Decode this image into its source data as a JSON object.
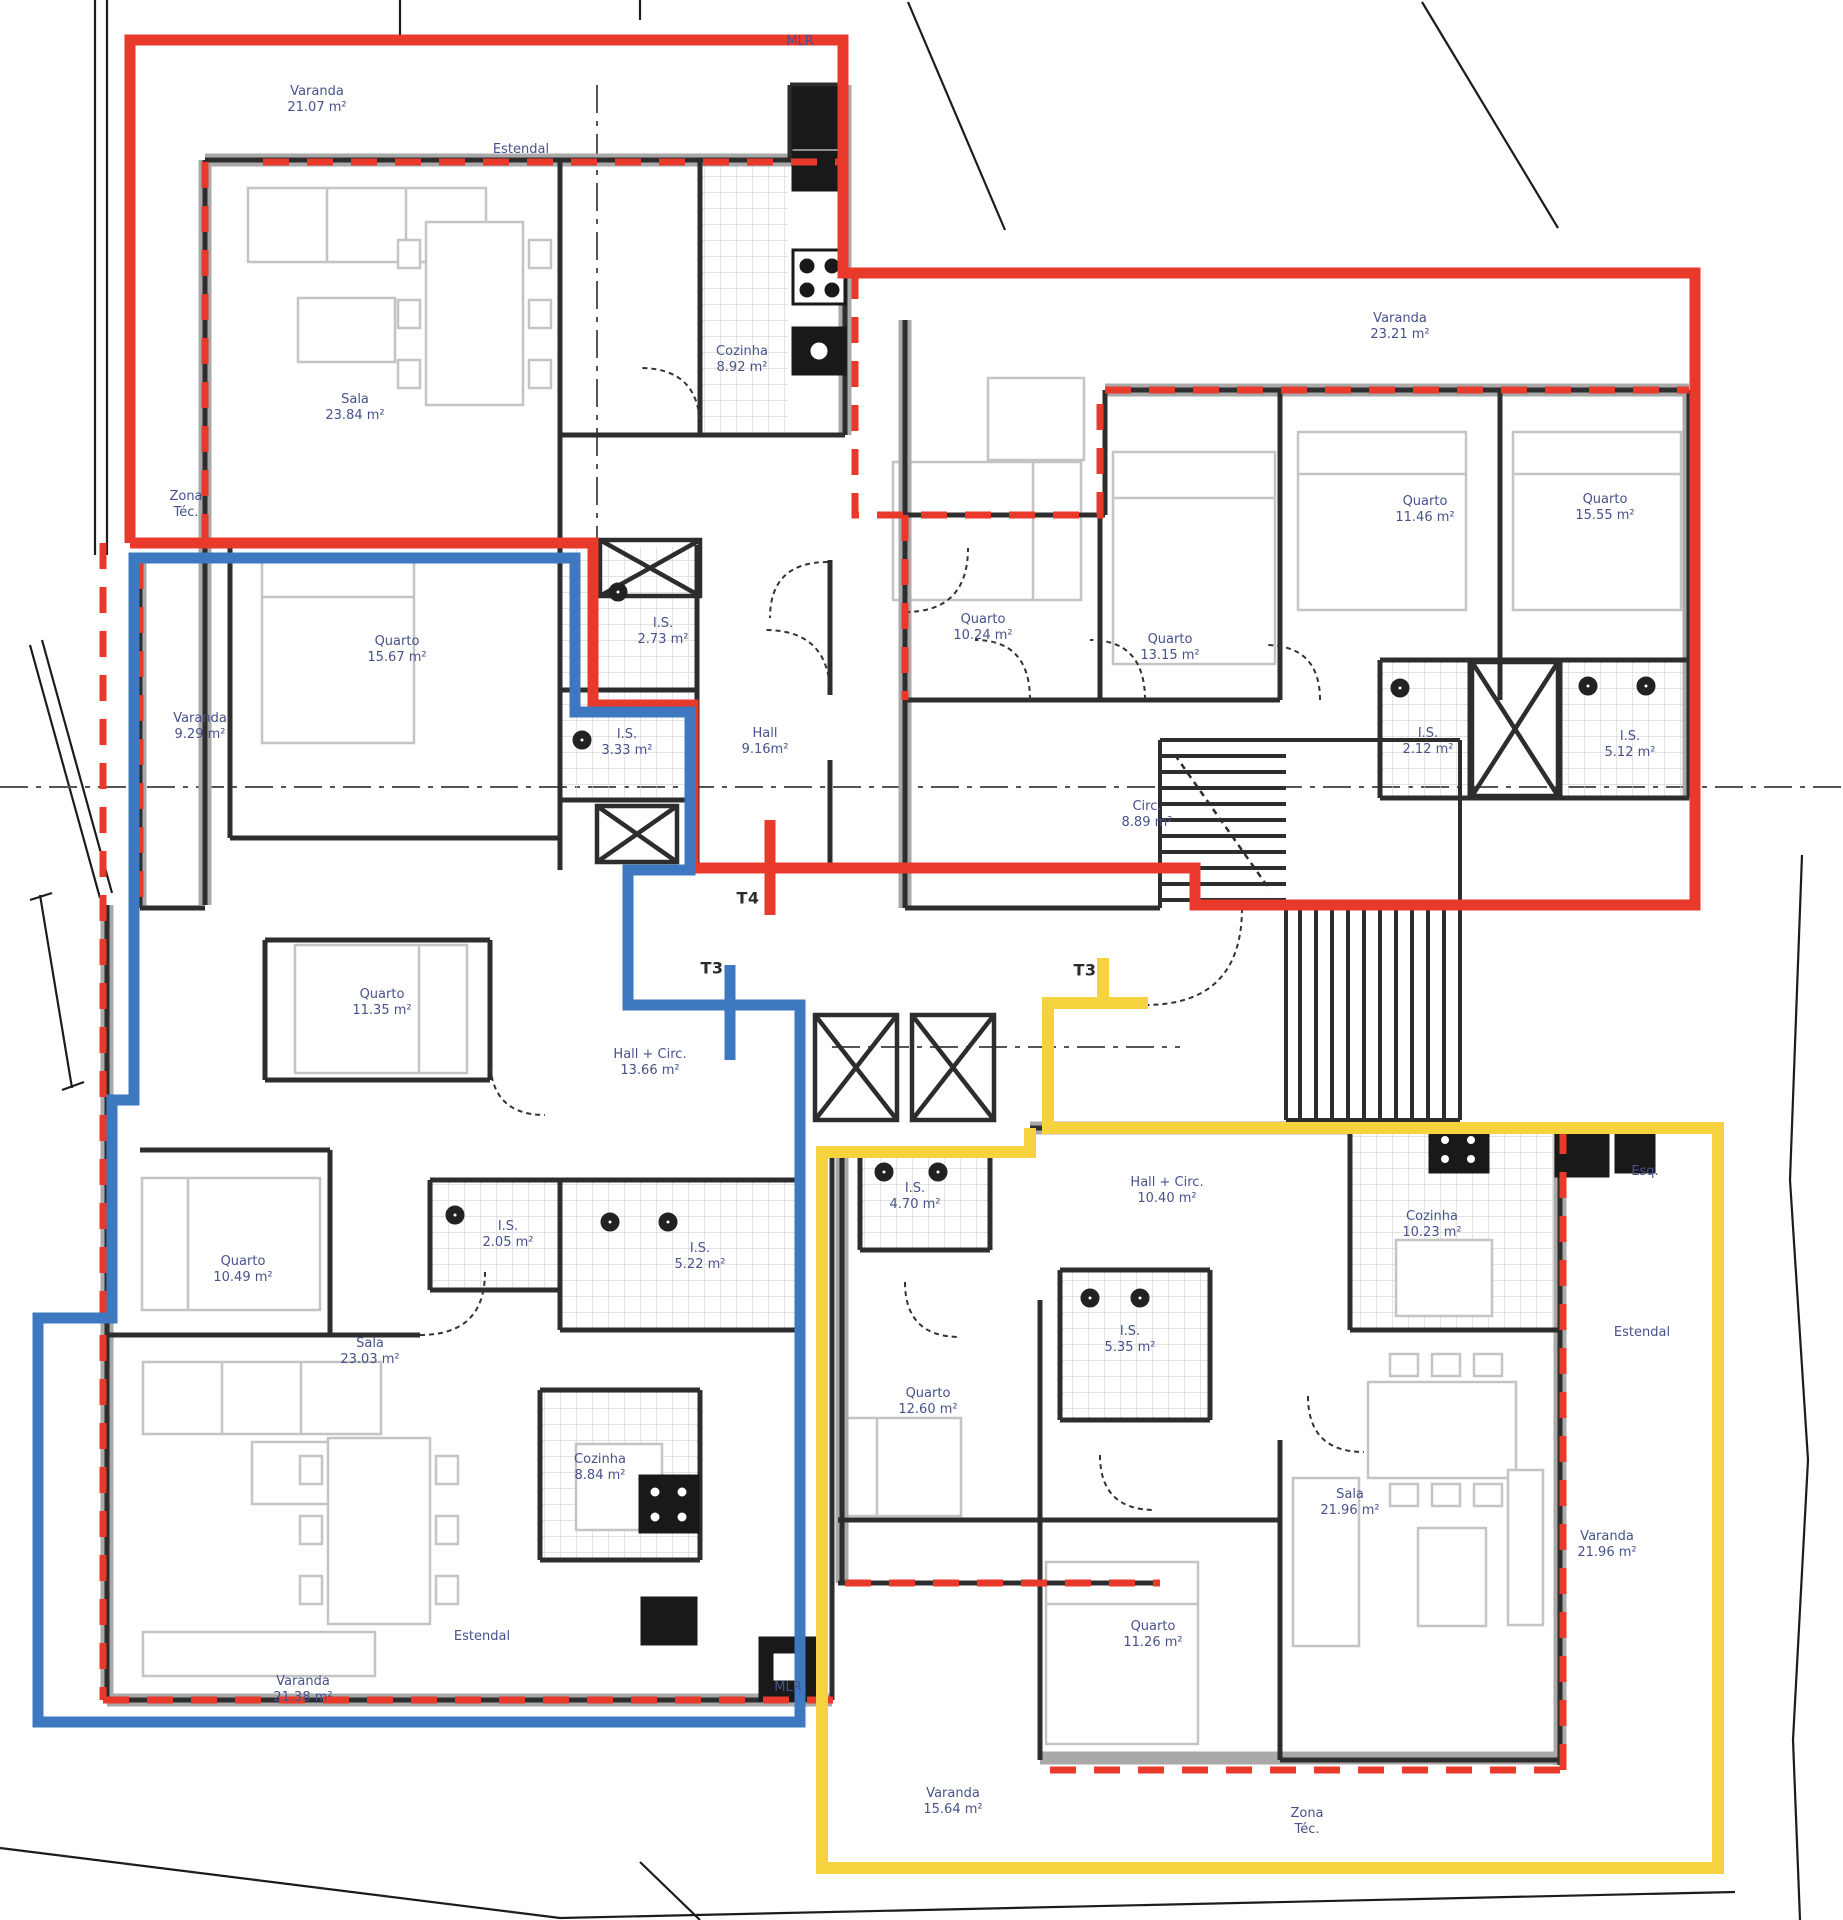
{
  "plan": {
    "kind": "architectural-floor-plan",
    "language": "pt",
    "units_shown": 3
  },
  "colors": {
    "apartment_red": "#e8392b",
    "apartment_blue": "#3d78c0",
    "apartment_yellow": "#f6d23e",
    "wall_dark": "#2d2d2d",
    "wall_gray": "#a9a9a9",
    "furniture": "#c4c4c4",
    "label_blue": "#47528a"
  },
  "apartments": [
    {
      "id": "apartment-red",
      "marker": {
        "label": "T4",
        "x": 748,
        "y": 898
      },
      "labels": [
        {
          "text": "Varanda",
          "sub": "21.07 m²",
          "x": 317,
          "y": 100
        },
        {
          "text": "Estendal",
          "sub": "",
          "x": 521,
          "y": 150
        },
        {
          "text": "MLR",
          "sub": "",
          "x": 800,
          "y": 42
        },
        {
          "text": "Sala",
          "sub": "23.84 m²",
          "x": 355,
          "y": 408
        },
        {
          "text": "Cozinha",
          "sub": "8.92 m²",
          "x": 742,
          "y": 360
        },
        {
          "text": "Zona",
          "sub": "Téc.",
          "x": 186,
          "y": 505
        },
        {
          "text": "Quarto",
          "sub": "15.67 m²",
          "x": 397,
          "y": 650
        },
        {
          "text": "Varanda",
          "sub": "9.29 m²",
          "x": 200,
          "y": 727
        },
        {
          "text": "I.S.",
          "sub": "2.73 m²",
          "x": 663,
          "y": 632
        },
        {
          "text": "I.S.",
          "sub": "3.33 m²",
          "x": 627,
          "y": 743
        },
        {
          "text": "Hall",
          "sub": "9.16m²",
          "x": 765,
          "y": 742
        },
        {
          "text": "Varanda",
          "sub": "23.21 m²",
          "x": 1400,
          "y": 327
        },
        {
          "text": "Quarto",
          "sub": "10.24 m²",
          "x": 983,
          "y": 628
        },
        {
          "text": "Quarto",
          "sub": "13.15 m²",
          "x": 1170,
          "y": 648
        },
        {
          "text": "Quarto",
          "sub": "11.46 m²",
          "x": 1425,
          "y": 510
        },
        {
          "text": "Quarto",
          "sub": "15.55 m²",
          "x": 1605,
          "y": 508
        },
        {
          "text": "I.S.",
          "sub": "2.12 m²",
          "x": 1428,
          "y": 742
        },
        {
          "text": "I.S.",
          "sub": "5.12 m²",
          "x": 1630,
          "y": 745
        },
        {
          "text": "Circ.",
          "sub": "8.89 m²",
          "x": 1147,
          "y": 815
        }
      ]
    },
    {
      "id": "apartment-blue",
      "marker": {
        "label": "T3",
        "x": 712,
        "y": 968
      },
      "labels": [
        {
          "text": "Quarto",
          "sub": "11.35 m²",
          "x": 382,
          "y": 1003
        },
        {
          "text": "Quarto",
          "sub": "10.49 m²",
          "x": 243,
          "y": 1270
        },
        {
          "text": "I.S.",
          "sub": "2.05 m²",
          "x": 508,
          "y": 1235
        },
        {
          "text": "Hall + Circ.",
          "sub": "13.66 m²",
          "x": 650,
          "y": 1063
        },
        {
          "text": "I.S.",
          "sub": "5.22 m²",
          "x": 700,
          "y": 1257
        },
        {
          "text": "Sala",
          "sub": "23.03 m²",
          "x": 370,
          "y": 1352
        },
        {
          "text": "Cozinha",
          "sub": "8.84 m²",
          "x": 600,
          "y": 1468
        },
        {
          "text": "Estendal",
          "sub": "",
          "x": 482,
          "y": 1637
        },
        {
          "text": "Varanda",
          "sub": "21.38 m²",
          "x": 303,
          "y": 1690
        },
        {
          "text": "MLR",
          "sub": "",
          "x": 788,
          "y": 1688
        }
      ]
    },
    {
      "id": "apartment-yellow",
      "marker": {
        "label": "T3",
        "x": 1085,
        "y": 970
      },
      "labels": [
        {
          "text": "I.S.",
          "sub": "4.70 m²",
          "x": 915,
          "y": 1197
        },
        {
          "text": "Hall + Circ.",
          "sub": "10.40 m²",
          "x": 1167,
          "y": 1191
        },
        {
          "text": "I.S.",
          "sub": "5.35 m²",
          "x": 1130,
          "y": 1340
        },
        {
          "text": "Quarto",
          "sub": "12.60 m²",
          "x": 928,
          "y": 1402
        },
        {
          "text": "Quarto",
          "sub": "11.26 m²",
          "x": 1153,
          "y": 1635
        },
        {
          "text": "Sala",
          "sub": "21.96 m²",
          "x": 1350,
          "y": 1503
        },
        {
          "text": "Cozinha",
          "sub": "10.23 m²",
          "x": 1432,
          "y": 1225
        },
        {
          "text": "Estendal",
          "sub": "",
          "x": 1642,
          "y": 1333
        },
        {
          "text": "Esq.",
          "sub": "",
          "x": 1645,
          "y": 1172
        },
        {
          "text": "Varanda",
          "sub": "21.96 m²",
          "x": 1607,
          "y": 1545
        },
        {
          "text": "Varanda",
          "sub": "15.64 m²",
          "x": 953,
          "y": 1802
        },
        {
          "text": "Zona",
          "sub": "Téc.",
          "x": 1307,
          "y": 1822
        }
      ]
    }
  ]
}
